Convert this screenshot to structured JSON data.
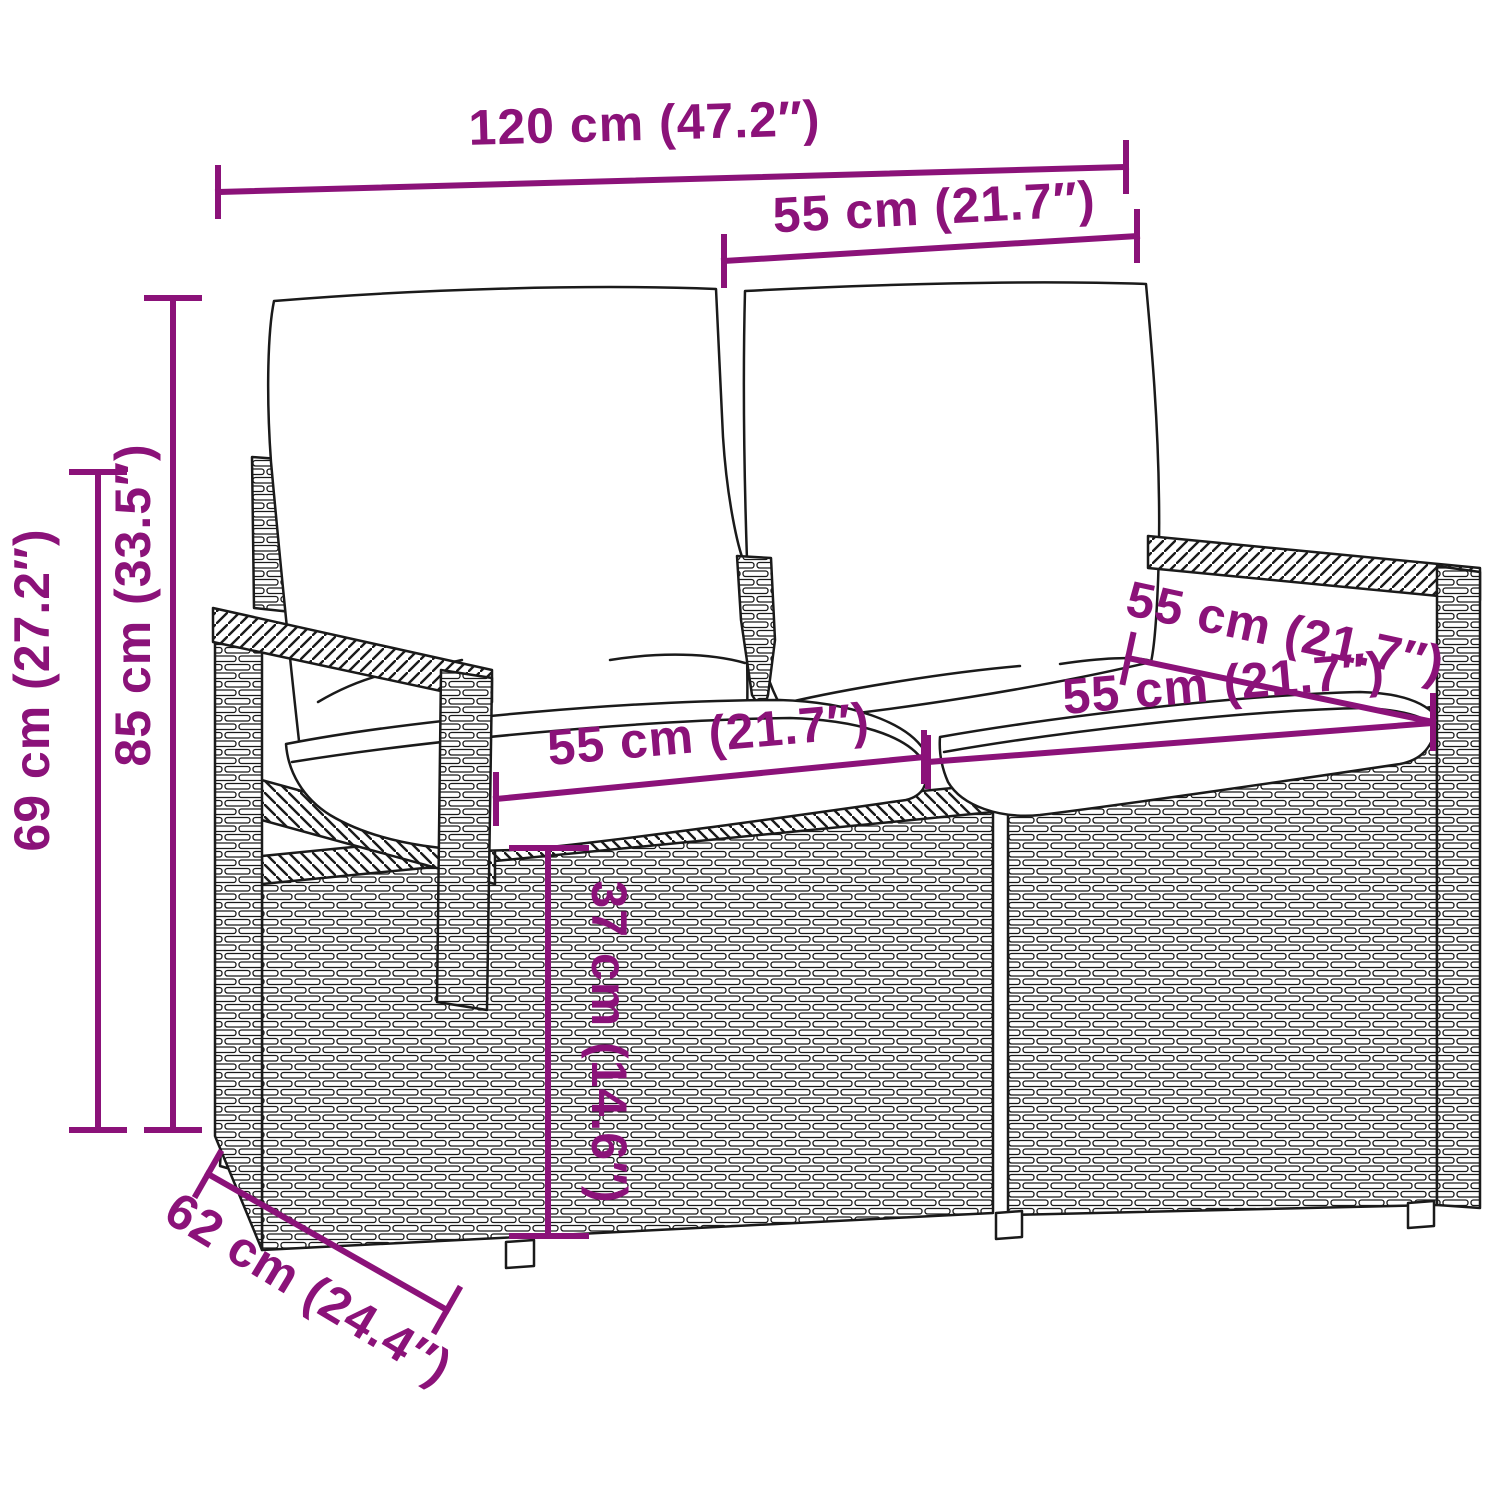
{
  "diagram": {
    "subject": "Poly rattan 2-seater garden bench with cushions — product dimension diagram",
    "colors": {
      "accent": "#8b1279",
      "line_art": "#1a1a1a",
      "background": "#ffffff"
    },
    "dimensions": {
      "total_width": "120 cm (47.2″)",
      "back_cushion_width": "55 cm (21.7″)",
      "total_height": "85 cm (33.5″)",
      "armrest_height": "69 cm (27.2″)",
      "seat_width_left": "55 cm (21.7″)",
      "seat_depth": "55 cm (21.7″)",
      "seat_width_right": "55 cm (21.7″)",
      "seat_height": "37 cm (14.6″)",
      "total_depth": "62 cm (24.4″)"
    }
  }
}
